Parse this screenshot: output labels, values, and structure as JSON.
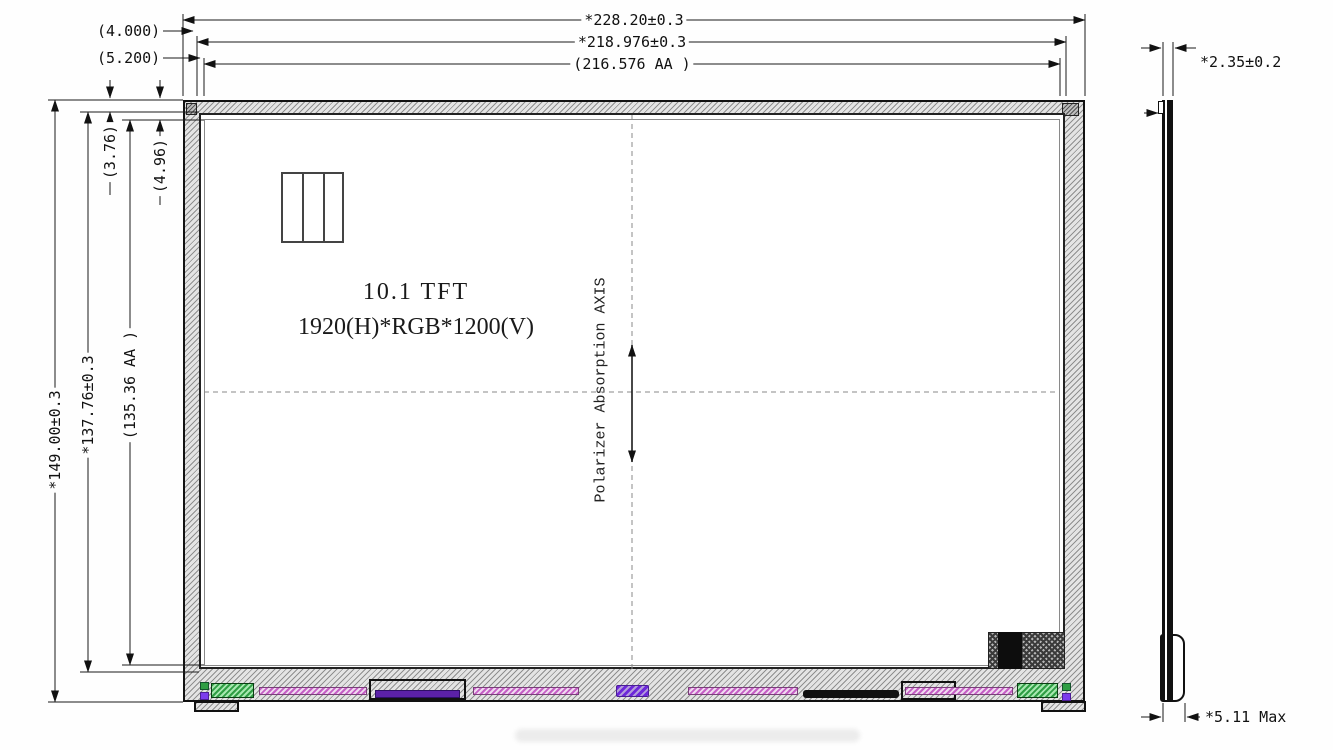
{
  "front": {
    "title": "10.1 TFT",
    "resolution": "1920(H)*RGB*1200(V)",
    "polarizer_axis": "Polarizer Absorption AXIS"
  },
  "dims": {
    "outline_width": "*228.20±0.3",
    "bezel_width": "*218.976±0.3",
    "active_width": "(216.576 AA )",
    "bezel_left_offset": "(4.000)",
    "active_left_offset": "(5.200)",
    "outline_height": "*149.00±0.3",
    "bezel_height": "*137.76±0.3",
    "active_height": "(135.36 AA )",
    "bezel_top_offset": "(3.76)",
    "active_top_offset": "(4.96)",
    "thickness": "*2.35±0.2",
    "max_thickness": "*5.11 Max"
  },
  "colors": {
    "line": "#1a1a1a",
    "hatch_light": "#e4e4e4",
    "hatch_dark": "#8f8f8f",
    "component_green": "#2f9e44",
    "component_magenta": "#c55fc5",
    "component_purple": "#5b21a8",
    "component_black": "#111111"
  }
}
